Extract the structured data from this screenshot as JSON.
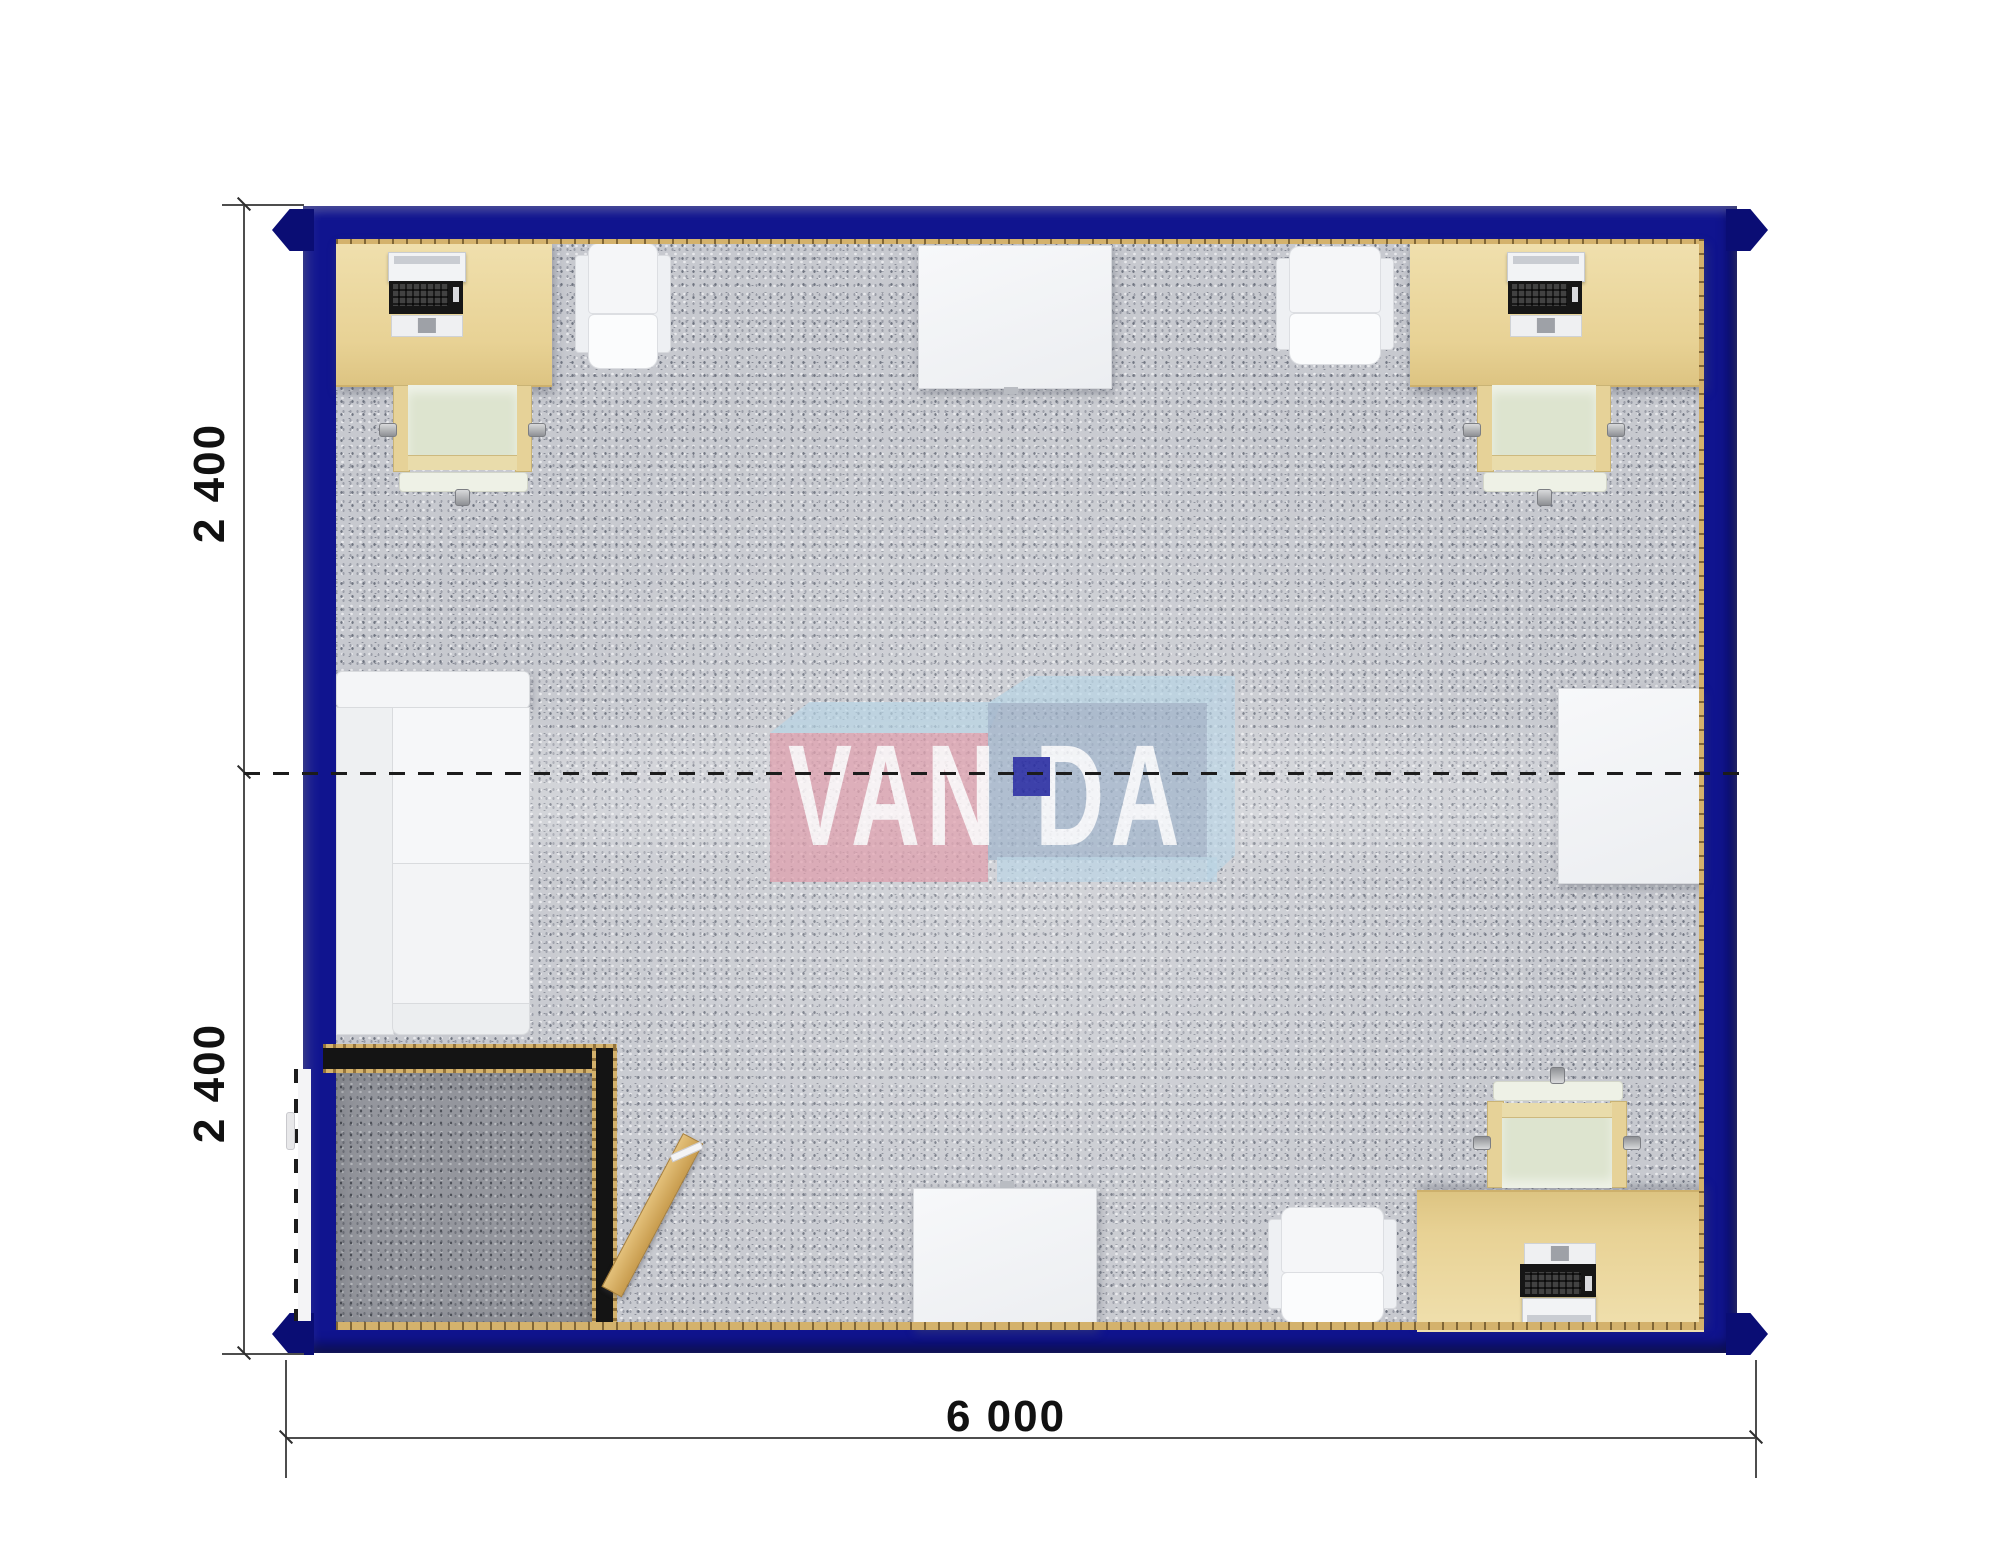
{
  "plan": {
    "description": "Top-view floor plan render of a 6000 x 4800 mm modular office container with two joined 2400 mm modules",
    "module_joint": "dashed line across the middle of the plan"
  },
  "dimensions": {
    "side_upper": "2 400",
    "side_lower": "2 400",
    "bottom": "6 000"
  },
  "watermark": {
    "text_left": "VAN",
    "text_right": "DA"
  },
  "colors": {
    "wall": "#10148f",
    "casting": "#0a0d74",
    "carpet": "#c7c9cf",
    "carpet-dark": "#94969d",
    "trim-gold": "#d4b26c",
    "black-wall": "#141414",
    "chair-tan": "#e6d298",
    "chair-sage": "#dde4cf",
    "chair-pale": "#eef1e6",
    "logo-pink": "#e09eab",
    "logo-blue": "#9bb0c8",
    "logo-light": "#b7d4e6",
    "logo-square": "#1c1f9f",
    "dim-line": "#4d4d4d",
    "text": "#111111"
  }
}
